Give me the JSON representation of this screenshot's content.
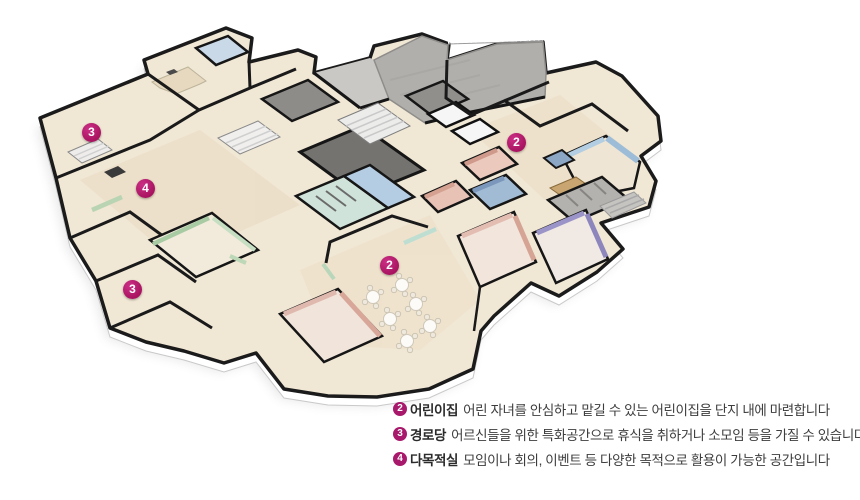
{
  "plan": {
    "markers": [
      {
        "num": "3"
      },
      {
        "num": "4"
      },
      {
        "num": "3"
      },
      {
        "num": "2"
      },
      {
        "num": "2"
      }
    ],
    "accent_color": "#a8186b"
  },
  "legend": {
    "items": [
      {
        "num": "2",
        "label": "어린이집",
        "text": "어린 자녀를 안심하고 맡길 수 있는 어린이집을 단지 내에 마련합니다"
      },
      {
        "num": "3",
        "label": "경로당",
        "text": "어르신들을 위한 특화공간으로 휴식을 취하거나 소모임 등을 가질 수 있습니다"
      },
      {
        "num": "4",
        "label": "다목적실",
        "text": "모임이나 회의, 이벤트 등 다양한 목적으로 활용이 가능한 공간입니다"
      }
    ]
  }
}
